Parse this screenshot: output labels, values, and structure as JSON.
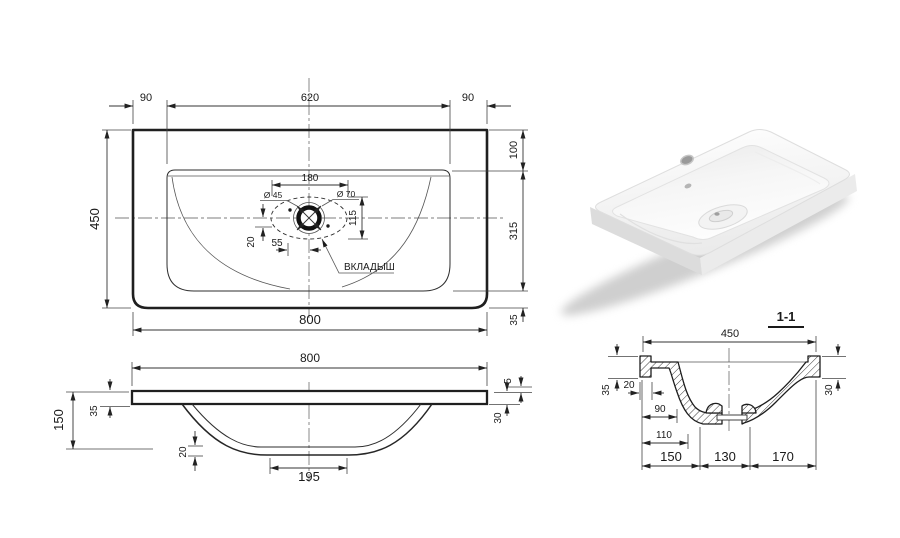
{
  "top_view": {
    "dims": {
      "left_offset": "90",
      "bowl_width": "620",
      "right_offset": "90",
      "depth": "450",
      "back_offset": "100",
      "bowl_depth": "315",
      "front_offset": "35",
      "width": "800",
      "drain_span": "180",
      "drain_dia_small": "Ø 45",
      "drain_dia_big": "Ø 70",
      "drain_height": "115",
      "drain_offset_y": "20",
      "drain_offset_x": "55"
    },
    "labels": {
      "insert": "ВКЛАДЫШ"
    }
  },
  "front_view": {
    "dims": {
      "width": "800",
      "height": "150",
      "rim": "35",
      "bottom_thickness": "20",
      "flat_bottom": "195",
      "lip": "5",
      "edge": "30"
    }
  },
  "section_view": {
    "title": "1-1",
    "dims": {
      "width": "450",
      "rim": "35",
      "rim_width": "20",
      "ledge": "90",
      "wall": "110",
      "seg_left": "150",
      "seg_mid": "130",
      "seg_right": "170",
      "edge": "30"
    }
  },
  "colors": {
    "line": "#1f1f1f",
    "centerline": "#7d7d7d",
    "paper": "#ffffff"
  }
}
